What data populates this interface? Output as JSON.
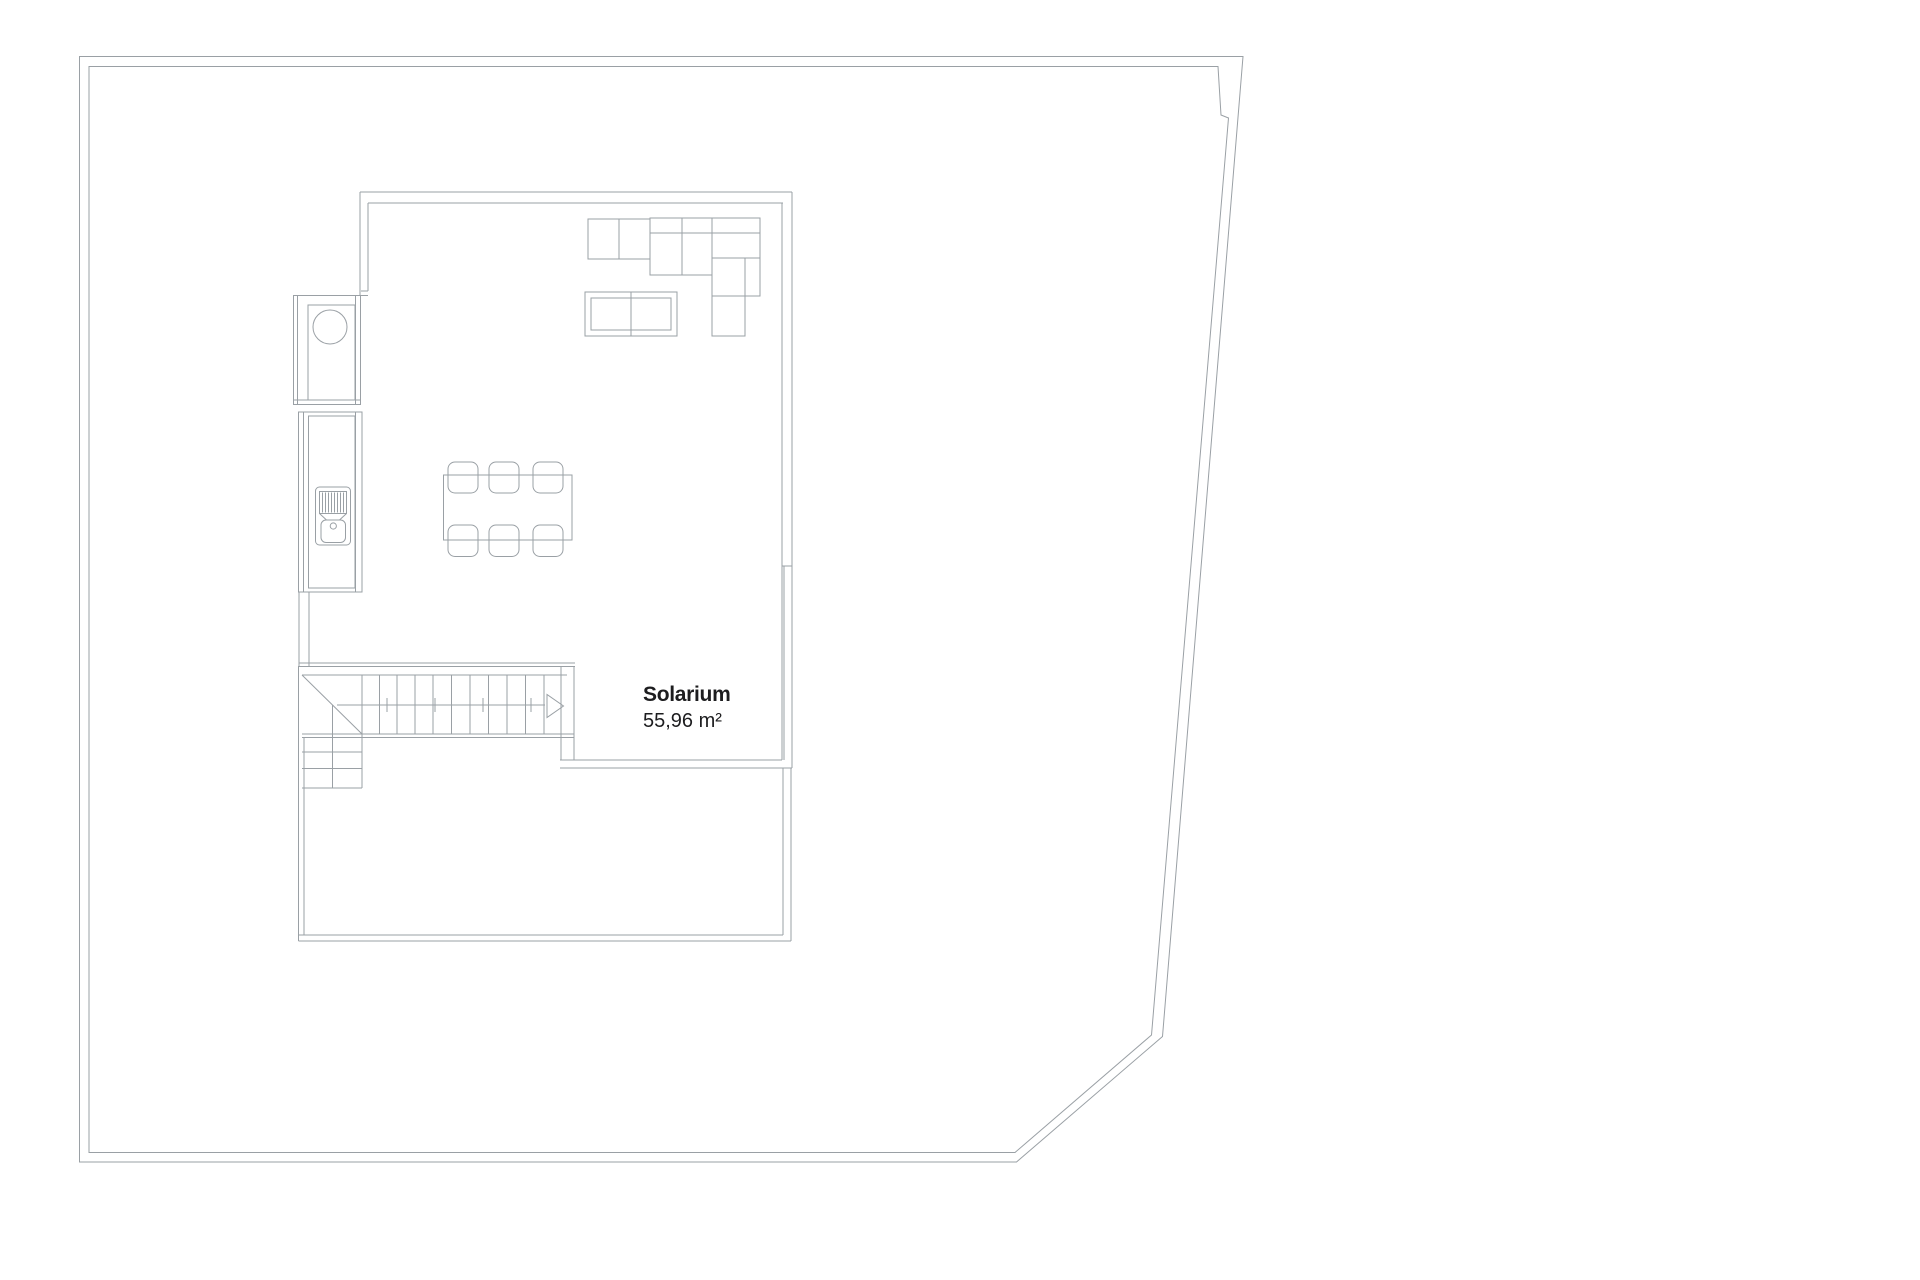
{
  "document": {
    "type": "architectural floor plan",
    "background": "#ffffff"
  },
  "room": {
    "label": "Solarium",
    "area": "55,96 m²"
  },
  "colors": {
    "boundary": "#d3d6d9",
    "walls": "#9aa0a5",
    "wallsDark": "#85898d",
    "furniture": "#a7acb0",
    "kitchen": "#55595d",
    "kitchenLight": "#8f9499",
    "stairs": "#8f9499",
    "stairDiagonal": "#5f6367",
    "walkline": "#c3c7ca",
    "arrow": "#b5b9bc",
    "text": "#1d1d1f"
  }
}
